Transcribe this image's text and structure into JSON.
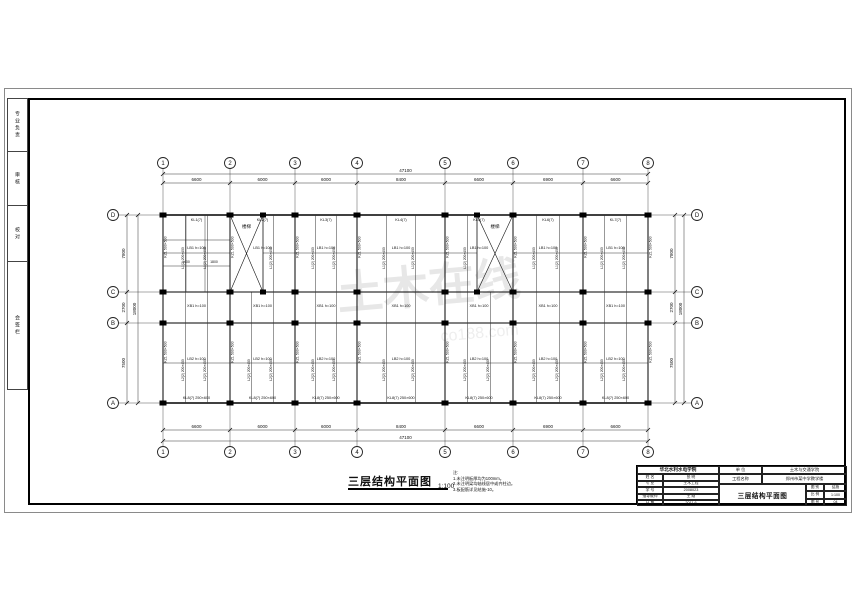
{
  "sheet": {
    "kind": "structural CAD drawing sheet"
  },
  "side_strip": {
    "boxes": [
      {
        "text": "专业负责"
      },
      {
        "text": "审核"
      },
      {
        "text": "校对"
      },
      {
        "text": "会签栏"
      }
    ]
  },
  "watermark": {
    "text": "土木在线",
    "sub": "co188.com",
    "color": "#e7e7e7"
  },
  "plan": {
    "title": "三层结构平面图",
    "scale": "1:100",
    "col_labels": [
      "1",
      "2",
      "3",
      "4",
      "5",
      "6",
      "7",
      "8"
    ],
    "row_labels": [
      "D",
      "C",
      "B",
      "A"
    ],
    "dims_top": [
      "6600",
      "6000",
      "6000",
      "8400",
      "6600",
      "6900",
      "6600"
    ],
    "dims_bottom": [
      "6600",
      "6000",
      "6000",
      "8400",
      "6600",
      "6900",
      "6600"
    ],
    "dim_total_h": "47100",
    "dims_left": [
      "7800",
      "2700",
      "7500"
    ],
    "dims_right": [
      "7800",
      "2700",
      "7500"
    ],
    "dim_total_v": "18000",
    "stair_label": "楼梯",
    "labels": {
      "top_beams": [
        "KL1(7)",
        "KL2(7)",
        "KL3(7)",
        "KL4(7)",
        "KL5(7)",
        "KL6(7)",
        "KL7(7)"
      ],
      "upper_slab": "LB1 h=100",
      "corridor_slab": "XB1 h=100",
      "lower_slab": "LB2 h=100",
      "bottom_beams": "KL8(7) 250×600",
      "column": "KZ1 500×500",
      "secondary_upper": "L1(2) 200×400",
      "secondary_lower": "L2(2) 200×450",
      "interior_dims": [
        "1400",
        "1800"
      ]
    }
  },
  "notes": {
    "title": "注:",
    "lines": [
      "1.未注明板厚均为100mm。",
      "2.未注明梁均轴线居中或齐柱边。",
      "3.板配筋详见结施-10。"
    ]
  },
  "title_block": {
    "school": "华北水利水电学院",
    "unit_label": "单 位",
    "unit_value": "土木与交通学院",
    "project_label": "工程名称",
    "project_value": "郑州市某中学教学楼",
    "drawing_title": "三层结构平面图",
    "rows": [
      {
        "label": "姓 名",
        "value": "张 明"
      },
      {
        "label": "专 业",
        "value": "土木工程"
      },
      {
        "label": "学 号",
        "value": "2008023"
      },
      {
        "label": "指导教师",
        "value": "王 刚"
      },
      {
        "label": "日 期",
        "value": "2011.6"
      }
    ],
    "mini": [
      {
        "label": "图 别",
        "value": "结施"
      },
      {
        "label": "比 例",
        "value": "1:100"
      },
      {
        "label": "图 号",
        "value": "04"
      }
    ]
  }
}
